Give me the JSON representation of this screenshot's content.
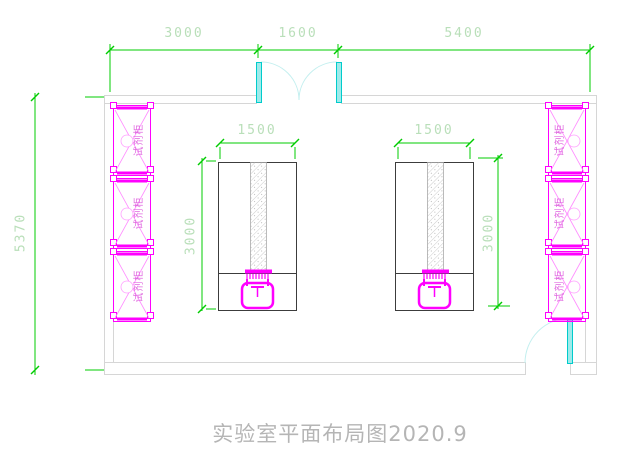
{
  "title": {
    "text": "实验室平面布局图2020.9"
  },
  "dimensions": {
    "top": {
      "seg1": "3000",
      "seg2": "1600",
      "seg3": "5400"
    },
    "left_height": "5370",
    "bench_width": "1500",
    "bench_depth": "3000"
  },
  "cabinets": {
    "label": "试剂柜",
    "left_count": 3,
    "right_count": 3
  },
  "colors": {
    "dimension_line": "#00cc00",
    "dimension_text": "#b9dfb9",
    "cabinet_outline": "#ff00ff",
    "cabinet_text": "#e06ae0",
    "door_leaf": "#9feaea",
    "door_swing": "#c3efef",
    "wall": "#d6d6d6",
    "bench_outline": "#3c3c3c",
    "title_text": "#b5b5b5"
  }
}
